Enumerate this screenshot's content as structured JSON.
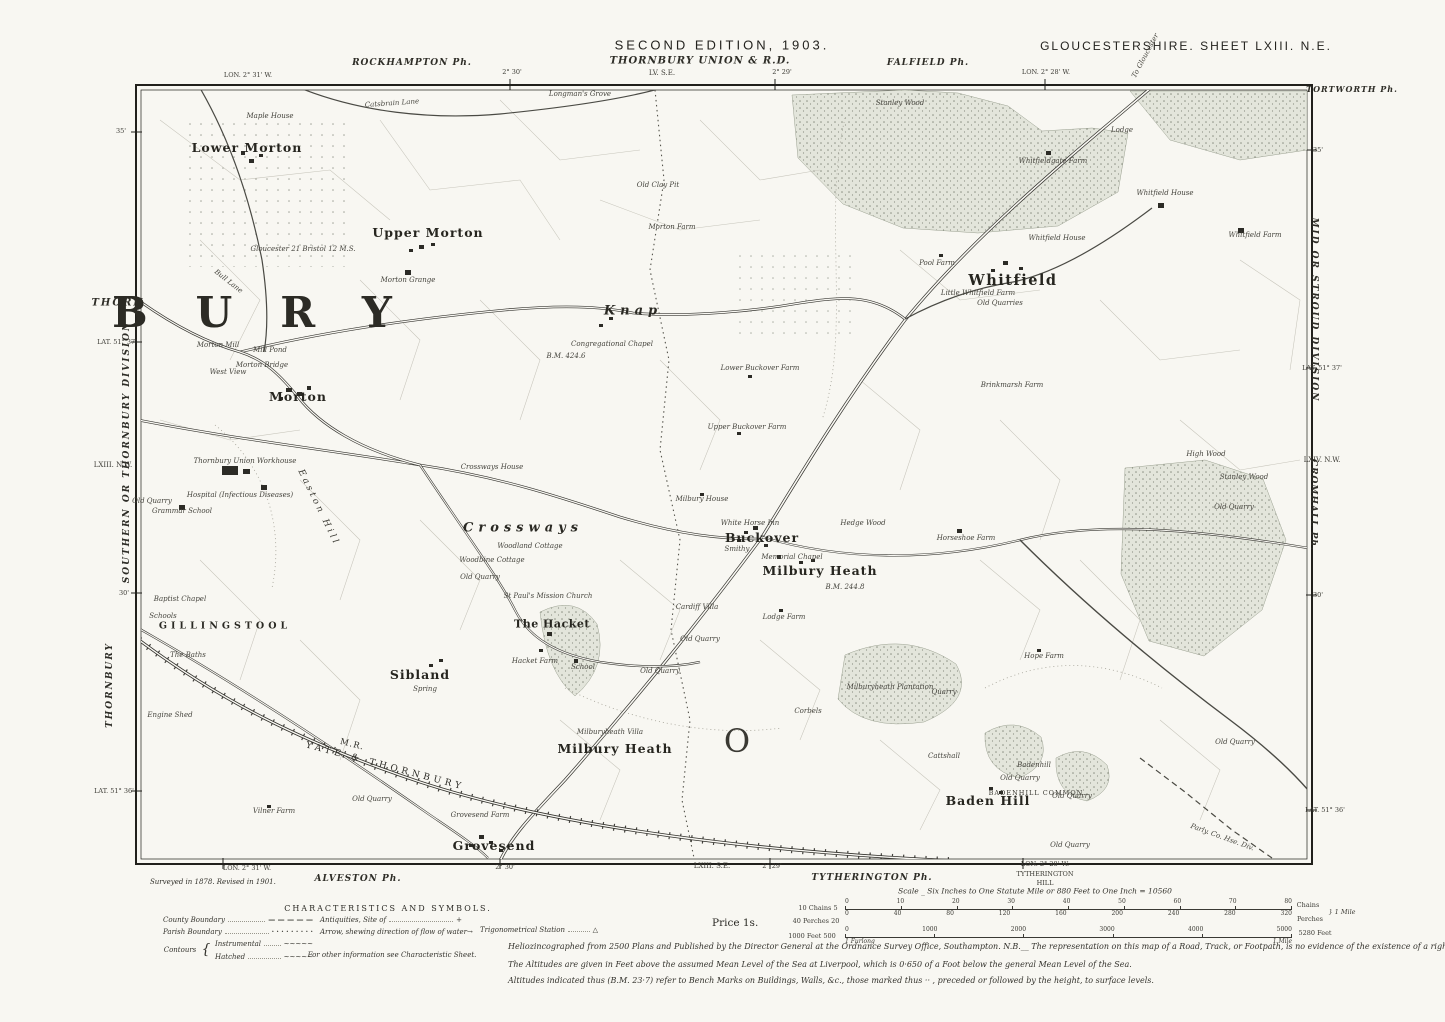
{
  "colors": {
    "paper": "#f8f7f2",
    "ink": "#2c2b26",
    "wood_fill": "#e3e5db",
    "wood_dot": "#8b9083"
  },
  "header": {
    "edition": "SECOND EDITION, 1903.",
    "sheet": "GLOUCESTERSHIRE.  SHEET LXIII.  N.E.",
    "union": "THORNBURY UNION & R.D.",
    "union_ref": "LV. S.E.",
    "rockhampton": "ROCKHAMPTON Ph.",
    "falfield": "FALFIELD Ph.",
    "lon_left": "LON. 2° 31' W.",
    "t230": "2° 30'",
    "t229": "2° 29'",
    "lon_right": "LON. 2° 28' W."
  },
  "margins": {
    "left": {
      "t35": "35'",
      "thorn": "THORN",
      "lat37": "LAT. 51° 37'",
      "division": "SOUTHERN  OR  THORNBURY  DIVISION",
      "ref": "LXIII. N.W.",
      "t30": "30'",
      "thornbury": "THORNBURY",
      "lat36": "LAT. 51° 36'"
    },
    "right": {
      "tortworth": "TORTWORTH Ph.",
      "t35": "35'",
      "division": "MID  OR  STROUD  DIVISION",
      "lat37": "LAT. 51° 37'",
      "ref": "LXIV. N.W.",
      "cromhall": "CROMHALL Ph.",
      "t30": "30'",
      "lat36": "LAT. 51° 36'"
    }
  },
  "footer": {
    "lon_left": "LON. 2° 31' W.",
    "alveston": "ALVESTON Ph.",
    "t230": "2° 30'",
    "ref_se": "LXIII. S.E.",
    "t229": "2° 29'",
    "tytherington": "TYTHERINGTON Ph.",
    "lon_right": "LON. 2° 28' W.",
    "tyth_hill_1": "TYTHERINGTON",
    "tyth_hill_2": "HILL",
    "surveyed": "Surveyed in 1878. Revised in 1901.",
    "price": "Price 1s."
  },
  "legend": {
    "title": "CHARACTERISTICS AND SYMBOLS.",
    "county": "County Boundary",
    "county_sym": "— — — — —",
    "parish": "Parish Boundary",
    "parish_sym": "· · · · · · · · ·",
    "contours": "Contours",
    "brace": "{",
    "instrumental": "Instrumental",
    "instrumental_sym": "~~~~~",
    "hatched": "Hatched",
    "hatched_sym": "~~~~~",
    "antiquities": "Antiquities, Site of",
    "antiquities_sym": "+",
    "arrow": "Arrow, shewing direction of flow of water",
    "arrow_sym": "→",
    "trig": "Trigonometrical Station",
    "trig_sym": "△",
    "other": "For other information see Characteristic Sheet."
  },
  "scale": {
    "caption": "Scale _ Six Inches to One Statute Mile or 880 Feet to One Inch = 10560",
    "chains_left": "10 Chains 5",
    "chains_ticks": [
      "0",
      "10",
      "20",
      "30",
      "40",
      "50",
      "60",
      "70",
      "80"
    ],
    "chains_right": "Chains",
    "perches_left": "40 Perches 20",
    "perches_ticks": [
      "0",
      "40",
      "80",
      "120",
      "160",
      "200",
      "240",
      "280",
      "320"
    ],
    "perches_right": "Perches",
    "mile_brace": "} 1 Mile",
    "feet_left": "1000 Feet   500",
    "feet_ticks": [
      "0",
      "1000",
      "2000",
      "3000",
      "4000",
      "5000"
    ],
    "feet_right": "5280 Feet",
    "furlong_left": "1 Furlong",
    "furlong_right": "1 Mile"
  },
  "notes": {
    "line1": "Heliozincographed from 2500 Plans and Published by the Director General at the Ordnance Survey Office, Southampton.   N.B.__ The representation on this map of a Road, Track, or Footpath, is no evidence of the existence of a right of way.",
    "line2": "The Altitudes are given in Feet above the assumed Mean Level of the Sea at Liverpool, which is 0·650 of a Foot below the general Mean Level of the Sea.",
    "line3": "Altitudes indicated thus (B.M. 23·7) refer to Bench Marks on Buildings, Walls, &c., those marked thus ·· , preceded or followed by the height, to surface levels."
  },
  "map": {
    "places": [
      {
        "t": "Catsbrain Lane",
        "x": 392,
        "y": 104,
        "s": "t",
        "r": -4
      },
      {
        "t": "Longman's Grove",
        "x": 580,
        "y": 95,
        "s": "t"
      },
      {
        "t": "Maple House",
        "x": 270,
        "y": 117,
        "s": "t"
      },
      {
        "t": "Lower Morton",
        "x": 247,
        "y": 148,
        "s": "p"
      },
      {
        "t": "Old Clay Pit",
        "x": 658,
        "y": 186,
        "s": "t"
      },
      {
        "t": "Stanley Wood",
        "x": 900,
        "y": 104,
        "s": "t"
      },
      {
        "t": "Lodge",
        "x": 1122,
        "y": 131,
        "s": "t"
      },
      {
        "t": "Whitfieldgate Farm",
        "x": 1053,
        "y": 162,
        "s": "t"
      },
      {
        "t": "Whitfield House",
        "x": 1165,
        "y": 194,
        "s": "t"
      },
      {
        "t": "Whitfield Farm",
        "x": 1255,
        "y": 236,
        "s": "t"
      },
      {
        "t": "Upper Morton",
        "x": 428,
        "y": 233,
        "s": "p"
      },
      {
        "t": "Morton Farm",
        "x": 672,
        "y": 228,
        "s": "t"
      },
      {
        "t": "Whitfield House",
        "x": 1057,
        "y": 239,
        "s": "t"
      },
      {
        "t": "Gloucester 21   Bristol 12   M.S.",
        "x": 303,
        "y": 250,
        "s": "t"
      },
      {
        "t": "Pool Farm",
        "x": 937,
        "y": 264,
        "s": "t"
      },
      {
        "t": "Whitfield",
        "x": 1013,
        "y": 281,
        "s": "pl"
      },
      {
        "t": "Little Whitfield Farm",
        "x": 978,
        "y": 294,
        "s": "t"
      },
      {
        "t": "Old Quarries",
        "x": 1000,
        "y": 304,
        "s": "t"
      },
      {
        "t": "Morton Grange",
        "x": 408,
        "y": 281,
        "s": "t"
      },
      {
        "t": "BURY",
        "x": 276,
        "y": 313,
        "s": "huge"
      },
      {
        "t": "Knap",
        "x": 633,
        "y": 311,
        "s": "sp"
      },
      {
        "t": "Bull Lane",
        "x": 228,
        "y": 282,
        "s": "t",
        "r": 38
      },
      {
        "t": "Morton Mill",
        "x": 218,
        "y": 346,
        "s": "t"
      },
      {
        "t": "Mill Pond",
        "x": 270,
        "y": 351,
        "s": "t"
      },
      {
        "t": "Congregational Chapel",
        "x": 612,
        "y": 345,
        "s": "t"
      },
      {
        "t": "Morton Bridge",
        "x": 262,
        "y": 366,
        "s": "t"
      },
      {
        "t": "West View",
        "x": 228,
        "y": 373,
        "s": "t"
      },
      {
        "t": "B.M. 424.6",
        "x": 566,
        "y": 357,
        "s": "t"
      },
      {
        "t": "Lower Buckover Farm",
        "x": 760,
        "y": 369,
        "s": "t"
      },
      {
        "t": "Morton",
        "x": 298,
        "y": 397,
        "s": "p"
      },
      {
        "t": "Brinkmarsh Farm",
        "x": 1012,
        "y": 386,
        "s": "t"
      },
      {
        "t": "Upper Buckover Farm",
        "x": 747,
        "y": 428,
        "s": "t"
      },
      {
        "t": "Thornbury Union Workhouse",
        "x": 245,
        "y": 462,
        "s": "t"
      },
      {
        "t": "Hospital (Infectious Diseases)",
        "x": 240,
        "y": 496,
        "s": "t"
      },
      {
        "t": "Old Quarry",
        "x": 152,
        "y": 502,
        "s": "t"
      },
      {
        "t": "Grammar School",
        "x": 182,
        "y": 512,
        "s": "t"
      },
      {
        "t": "High Wood",
        "x": 1206,
        "y": 455,
        "s": "t"
      },
      {
        "t": "Stanley Wood",
        "x": 1244,
        "y": 478,
        "s": "t"
      },
      {
        "t": "Old Quarry",
        "x": 1234,
        "y": 508,
        "s": "t"
      },
      {
        "t": "Crossways House",
        "x": 492,
        "y": 468,
        "s": "t"
      },
      {
        "t": "Easton Hill",
        "x": 318,
        "y": 508,
        "s": "sp2",
        "r": 64
      },
      {
        "t": "Milbury House",
        "x": 702,
        "y": 500,
        "s": "t"
      },
      {
        "t": "Hedge Wood",
        "x": 863,
        "y": 524,
        "s": "t"
      },
      {
        "t": "White Horse Inn",
        "x": 750,
        "y": 524,
        "s": "t"
      },
      {
        "t": "Horseshoe Farm",
        "x": 966,
        "y": 539,
        "s": "t"
      },
      {
        "t": "Buckover",
        "x": 762,
        "y": 538,
        "s": "p"
      },
      {
        "t": "Crossways",
        "x": 523,
        "y": 528,
        "s": "sp"
      },
      {
        "t": "Smithy",
        "x": 737,
        "y": 550,
        "s": "t"
      },
      {
        "t": "Memorial Chapel",
        "x": 792,
        "y": 558,
        "s": "t"
      },
      {
        "t": "Milbury Heath",
        "x": 820,
        "y": 571,
        "s": "p"
      },
      {
        "t": "B.M. 244.8",
        "x": 845,
        "y": 588,
        "s": "t"
      },
      {
        "t": "Woodland Cottage",
        "x": 530,
        "y": 547,
        "s": "t"
      },
      {
        "t": "Woodbine Cottage",
        "x": 492,
        "y": 561,
        "s": "t"
      },
      {
        "t": "Old Quarry",
        "x": 480,
        "y": 578,
        "s": "t"
      },
      {
        "t": "St Paul's Mission Church",
        "x": 548,
        "y": 597,
        "s": "t"
      },
      {
        "t": "Cardiff Villa",
        "x": 697,
        "y": 608,
        "s": "t"
      },
      {
        "t": "Baptist Chapel",
        "x": 180,
        "y": 600,
        "s": "t"
      },
      {
        "t": "Schools",
        "x": 163,
        "y": 617,
        "s": "t"
      },
      {
        "t": "GILLINGSTOOL",
        "x": 225,
        "y": 626,
        "s": "caps"
      },
      {
        "t": "Lodge Farm",
        "x": 784,
        "y": 618,
        "s": "t"
      },
      {
        "t": "The Hacket",
        "x": 552,
        "y": 624,
        "s": "p2"
      },
      {
        "t": "The Baths",
        "x": 188,
        "y": 656,
        "s": "t"
      },
      {
        "t": "Old Quarry",
        "x": 700,
        "y": 640,
        "s": "t"
      },
      {
        "t": "Hacket Farm",
        "x": 535,
        "y": 662,
        "s": "t"
      },
      {
        "t": "School",
        "x": 583,
        "y": 668,
        "s": "t"
      },
      {
        "t": "Old Quarry",
        "x": 660,
        "y": 672,
        "s": "t"
      },
      {
        "t": "Sibland",
        "x": 420,
        "y": 675,
        "s": "p"
      },
      {
        "t": "Spring",
        "x": 425,
        "y": 690,
        "s": "t"
      },
      {
        "t": "Milburyheath Plantation",
        "x": 890,
        "y": 688,
        "s": "t"
      },
      {
        "t": "Quarry",
        "x": 944,
        "y": 693,
        "s": "t"
      },
      {
        "t": "Hope Farm",
        "x": 1044,
        "y": 657,
        "s": "t"
      },
      {
        "t": "Old Quarry",
        "x": 1235,
        "y": 743,
        "s": "t"
      },
      {
        "t": "Engine Shed",
        "x": 170,
        "y": 716,
        "s": "t"
      },
      {
        "t": "Corbels",
        "x": 808,
        "y": 712,
        "s": "t"
      },
      {
        "t": "Milburyheath Villa",
        "x": 610,
        "y": 733,
        "s": "t"
      },
      {
        "t": "Milbury Heath",
        "x": 615,
        "y": 749,
        "s": "p"
      },
      {
        "t": "O",
        "x": 737,
        "y": 741,
        "s": "bigO"
      },
      {
        "t": "Cattshall",
        "x": 944,
        "y": 757,
        "s": "t"
      },
      {
        "t": "Badenhill",
        "x": 1034,
        "y": 766,
        "s": "t"
      },
      {
        "t": "Old Quarry",
        "x": 1020,
        "y": 779,
        "s": "t"
      },
      {
        "t": "BADENHILL COMMON",
        "x": 1036,
        "y": 793,
        "s": "caps2"
      },
      {
        "t": "Old Quarry",
        "x": 1072,
        "y": 797,
        "s": "t"
      },
      {
        "t": "Baden Hill",
        "x": 988,
        "y": 801,
        "s": "p"
      },
      {
        "t": "Vilner Farm",
        "x": 274,
        "y": 812,
        "s": "t"
      },
      {
        "t": "Old Quarry",
        "x": 372,
        "y": 800,
        "s": "t"
      },
      {
        "t": "Grovesend Farm",
        "x": 480,
        "y": 816,
        "s": "t"
      },
      {
        "t": "Grovesend",
        "x": 494,
        "y": 846,
        "s": "p"
      },
      {
        "t": "Old Quarry",
        "x": 1070,
        "y": 846,
        "s": "t"
      },
      {
        "t": "Parly. Co. Hse. Div.",
        "x": 1222,
        "y": 838,
        "s": "t",
        "r": 20
      },
      {
        "t": "M.R.",
        "x": 352,
        "y": 745,
        "s": "rail",
        "r": 14
      },
      {
        "t": "YATE & THORNBURY",
        "x": 385,
        "y": 767,
        "s": "rail2",
        "r": 15
      },
      {
        "t": "To Gloucester",
        "x": 1146,
        "y": 56,
        "s": "t",
        "r": -62
      }
    ]
  }
}
